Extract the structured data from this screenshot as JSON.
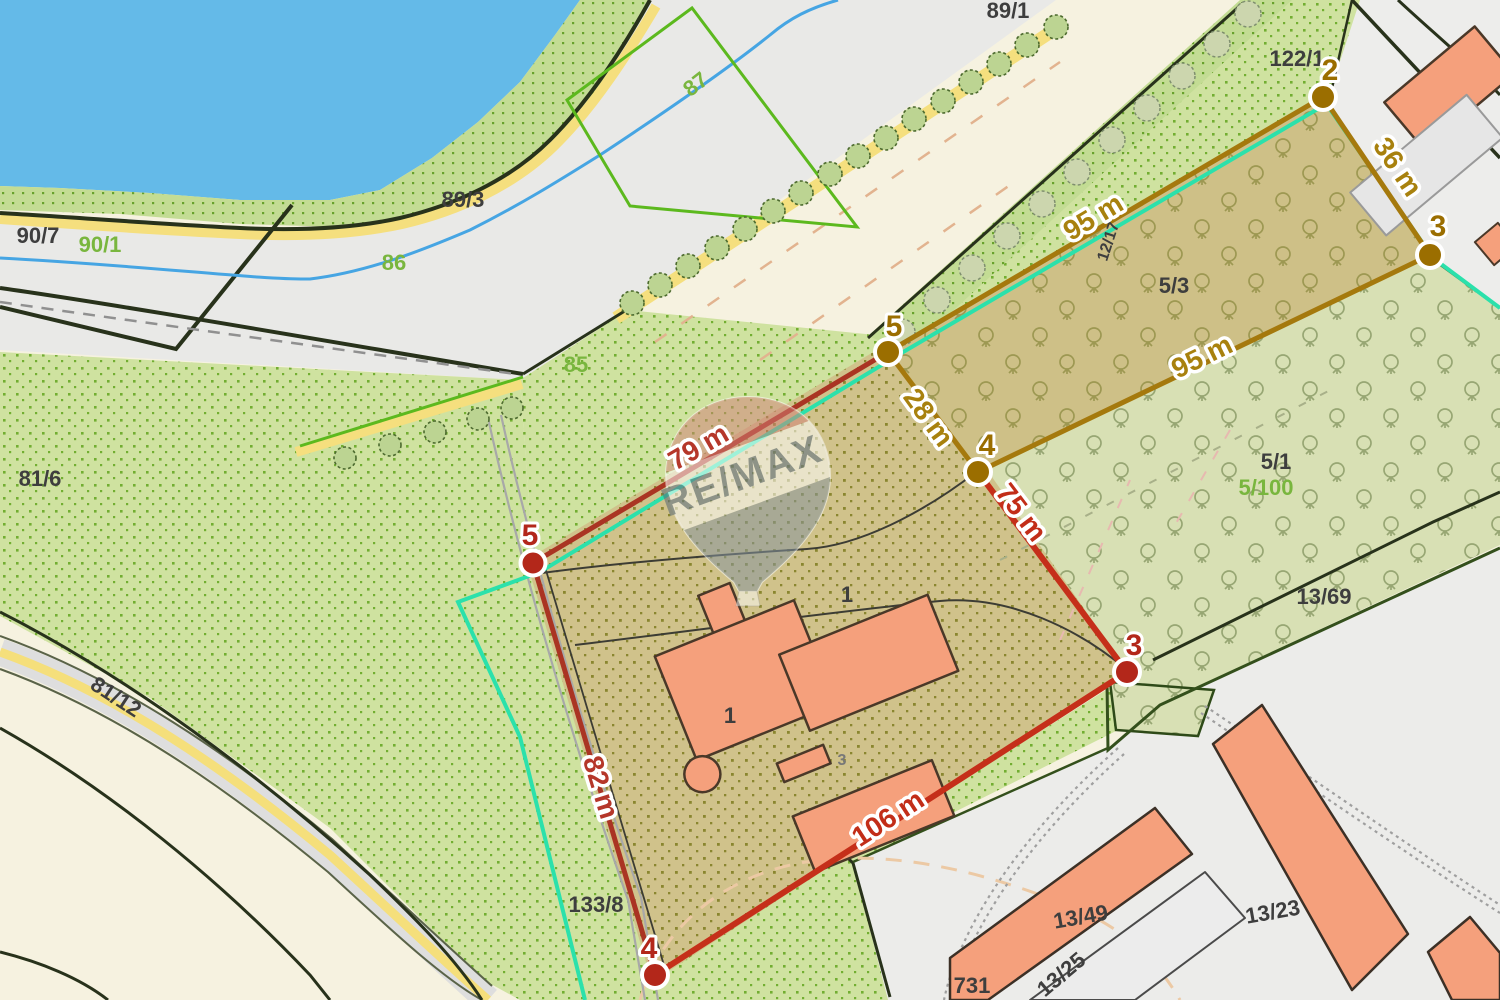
{
  "map": {
    "watermark": {
      "text": "RE/MAX"
    },
    "parcel_labels": [
      {
        "text": "89/1",
        "color": "dark"
      },
      {
        "text": "87",
        "color": "green"
      },
      {
        "text": "89/3",
        "color": "dark"
      },
      {
        "text": "90/7",
        "color": "dark"
      },
      {
        "text": "90/1",
        "color": "green"
      },
      {
        "text": "86",
        "color": "green"
      },
      {
        "text": "85",
        "color": "green"
      },
      {
        "text": "81/6",
        "color": "dark"
      },
      {
        "text": "81/12",
        "color": "dark"
      },
      {
        "text": "133/8",
        "color": "dark"
      },
      {
        "text": "122/1",
        "color": "dark"
      },
      {
        "text": "12/17",
        "color": "dark"
      },
      {
        "text": "5/3",
        "color": "dark"
      },
      {
        "text": "5/1",
        "color": "dark"
      },
      {
        "text": "5/100",
        "color": "green"
      },
      {
        "text": "13/69",
        "color": "dark"
      },
      {
        "text": "13/49",
        "color": "dark"
      },
      {
        "text": "13/25",
        "color": "dark"
      },
      {
        "text": "13/23",
        "color": "dark"
      },
      {
        "text": "731",
        "color": "dark"
      },
      {
        "text": "1",
        "color": "dark"
      },
      {
        "text": "1",
        "color": "dark"
      },
      {
        "text": "3",
        "color": "gray"
      }
    ],
    "measurements": [
      {
        "text": "79 m"
      },
      {
        "text": "82 m"
      },
      {
        "text": "106 m"
      },
      {
        "text": "75 m"
      },
      {
        "text": "28 m"
      },
      {
        "text": "95 m"
      },
      {
        "text": "95 m"
      },
      {
        "text": "36 m"
      }
    ],
    "vertices": [
      {
        "label": "2",
        "color": "brown"
      },
      {
        "label": "3",
        "color": "brown"
      },
      {
        "label": "4",
        "color": "brown"
      },
      {
        "label": "5",
        "color": "brown"
      },
      {
        "label": "5",
        "color": "red"
      },
      {
        "label": "3",
        "color": "red"
      },
      {
        "label": "4",
        "color": "red"
      }
    ],
    "colors": {
      "water": "#64bae8",
      "boundary_red": "#aa3423",
      "boundary_red_bright": "#c52f1a",
      "boundary_brown": "#a5790d",
      "boundary_cyan": "#2be1ab",
      "building": "#f5a07c",
      "vegetation_dot": "#72ae31",
      "path_yellow": "#f5df7e"
    }
  }
}
